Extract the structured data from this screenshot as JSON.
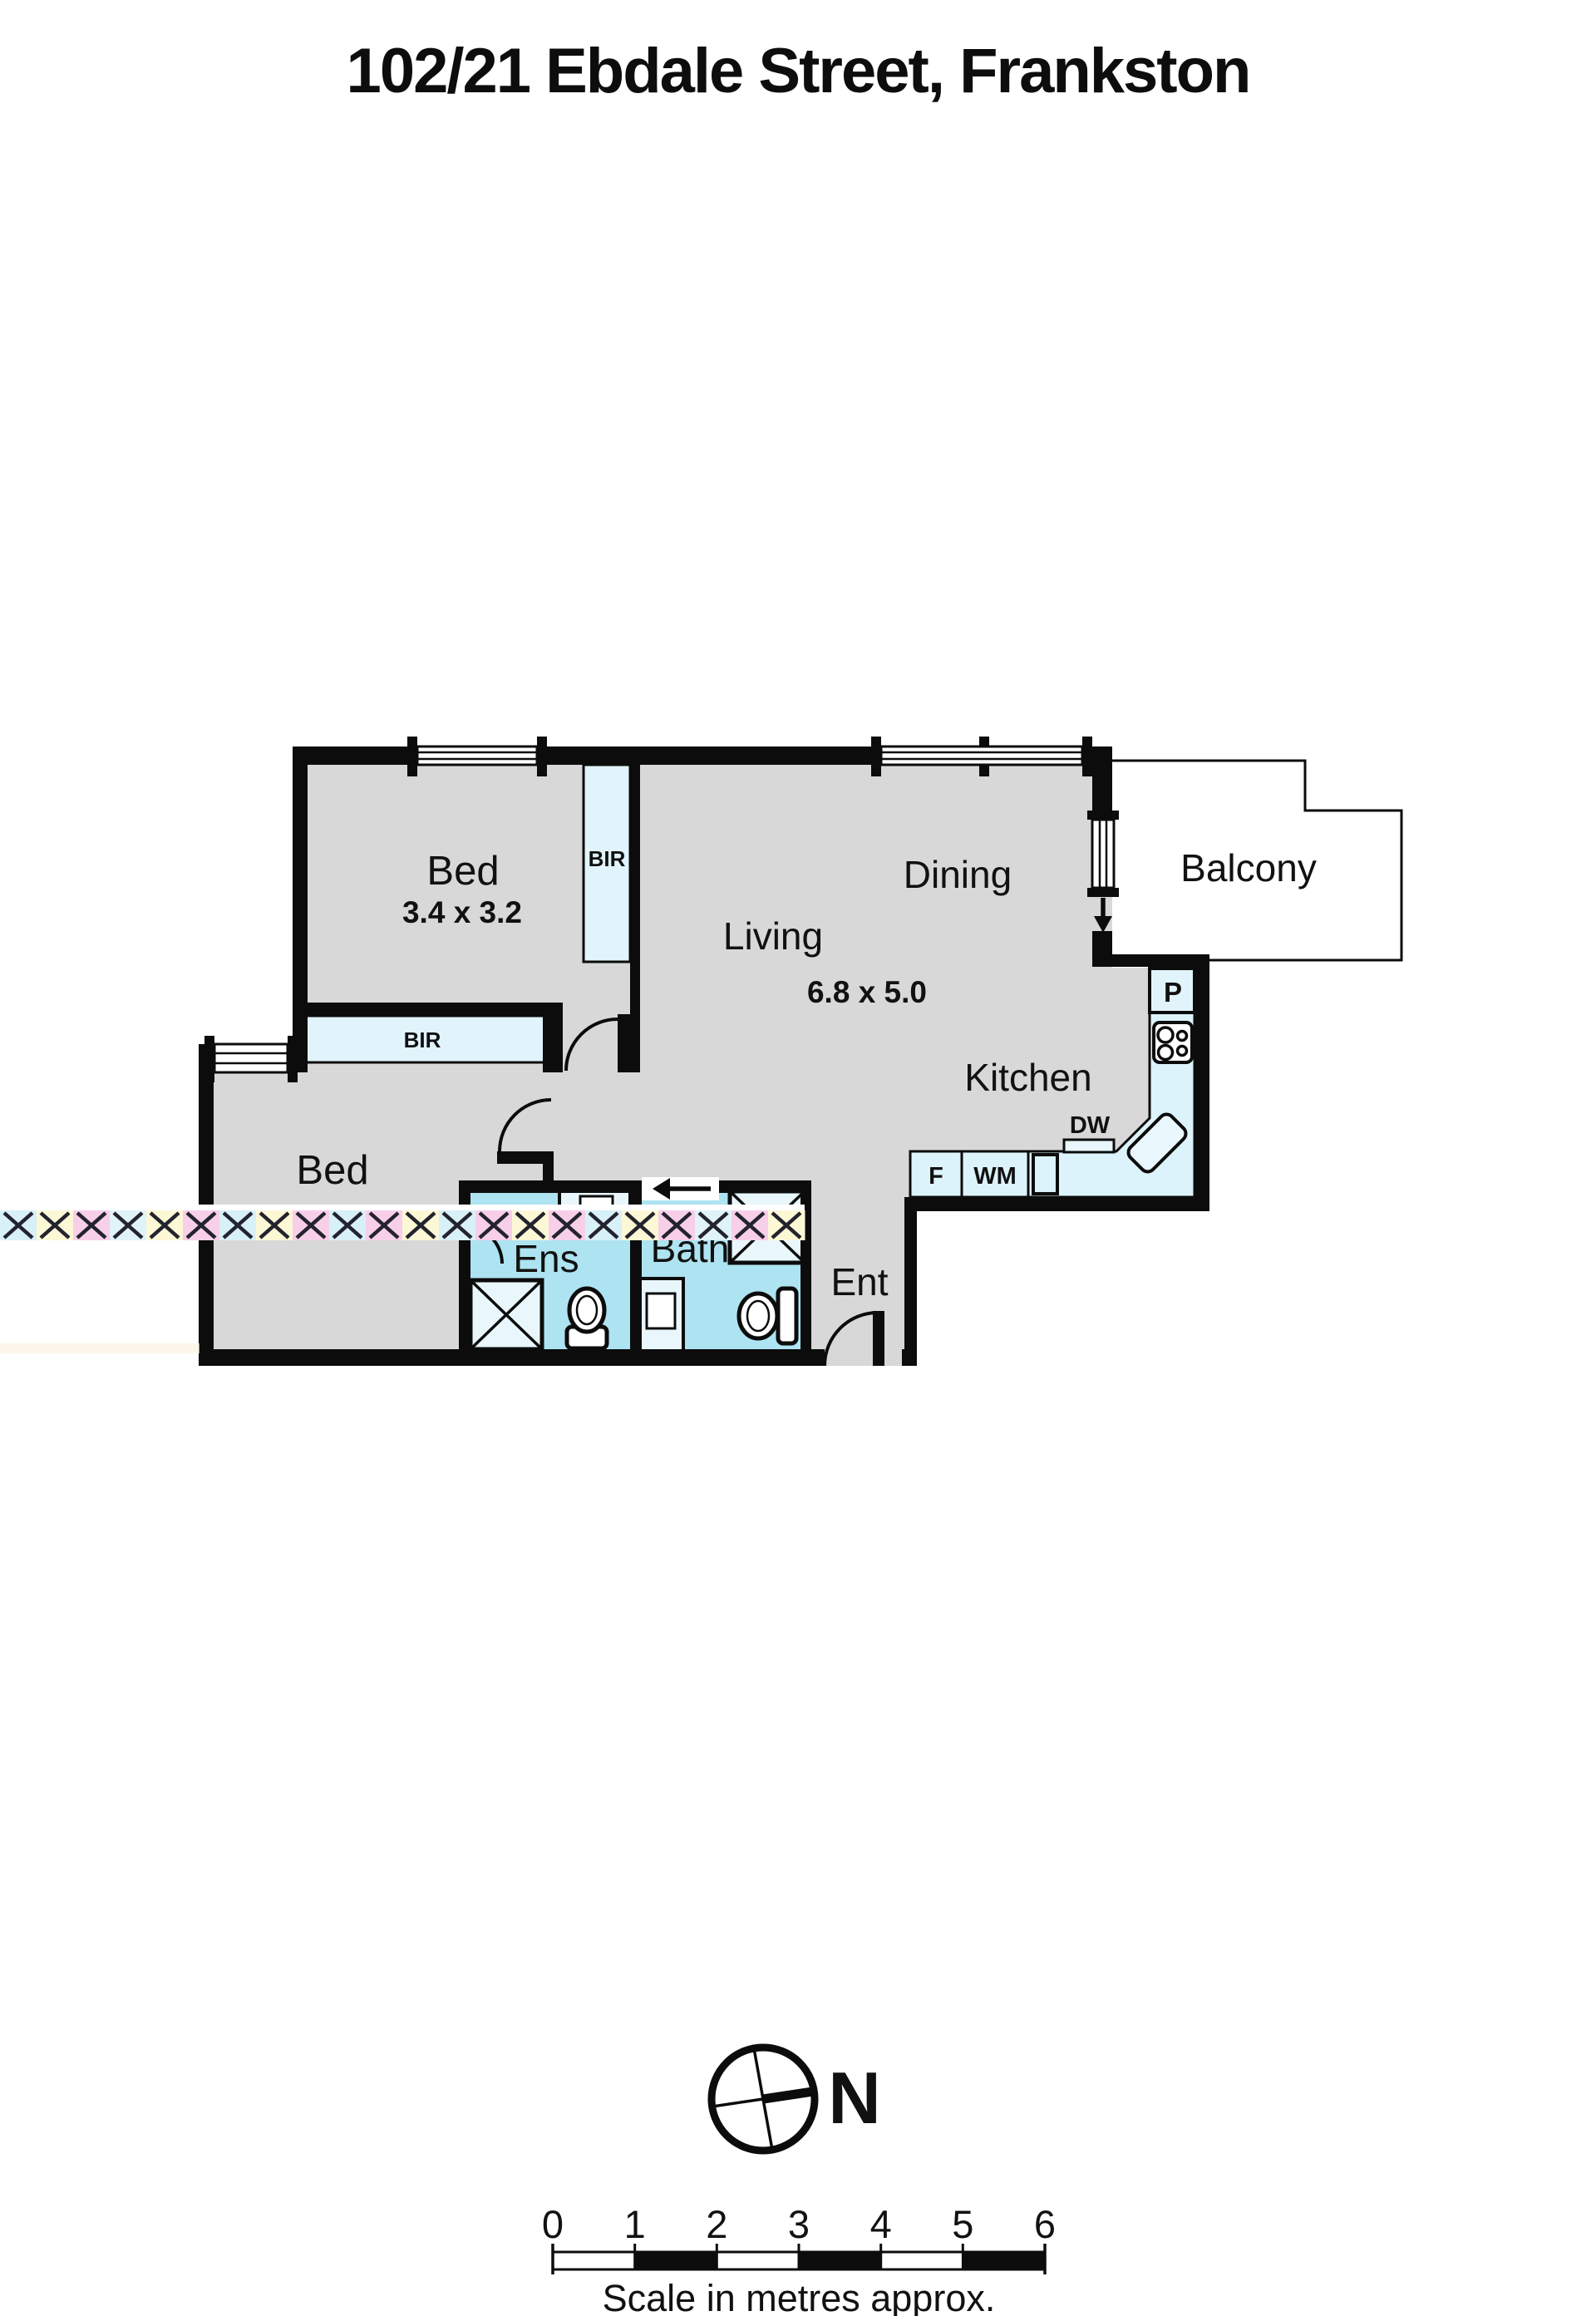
{
  "title": "102/21 Ebdale Street, Frankston",
  "rooms": {
    "bed1": {
      "label": "Bed",
      "dims": "3.4 x 3.2"
    },
    "living": {
      "label": "Living",
      "dims": "6.8 x 5.0"
    },
    "dining": {
      "label": "Dining"
    },
    "kitchen": {
      "label": "Kitchen"
    },
    "balcony": {
      "label": "Balcony"
    },
    "bed2": {
      "label": "Bed"
    },
    "ens": {
      "label": "Ens"
    },
    "bath": {
      "label": "Bath"
    },
    "entry": {
      "label": "Ent"
    }
  },
  "closets": {
    "bir1": "BIR",
    "bir2": "BIR"
  },
  "appliances": {
    "pantry": "P",
    "dishwasher": "DW",
    "fridge": "F",
    "washing_machine": "WM"
  },
  "compass": {
    "north_label": "N"
  },
  "scale_bar": {
    "ticks": [
      "0",
      "1",
      "2",
      "3",
      "4",
      "5",
      "6"
    ],
    "caption": "Scale in metres approx."
  },
  "colors": {
    "wall": "#0c0c0c",
    "floor": "#d8d8d8",
    "closet": "#e1f4fc",
    "bench": "#ddf3fb",
    "wet_area": "#aee3f1",
    "fixture": "#e9f7fd",
    "white": "#ffffff",
    "text": "#111111"
  },
  "watermark": {
    "tile_colors": [
      "#d8f0f8",
      "#fcf8d6",
      "#f8cfe8",
      "#dff3f9",
      "#fcf8d6",
      "#f8cfe8",
      "#d8f0f8",
      "#fcf8d6",
      "#f8cfe8",
      "#d8f0f8",
      "#f8cfe8",
      "#fcf8d6",
      "#d8f0f8",
      "#f8cfe8",
      "#fcf8d6",
      "#f8cfe8",
      "#d8f0f8",
      "#fcf8d6",
      "#f8cfe8",
      "#dff3f9",
      "#f8cfe8",
      "#fcf8d6"
    ],
    "x_color": "#23232e",
    "streak_color": "#faf3dc"
  }
}
